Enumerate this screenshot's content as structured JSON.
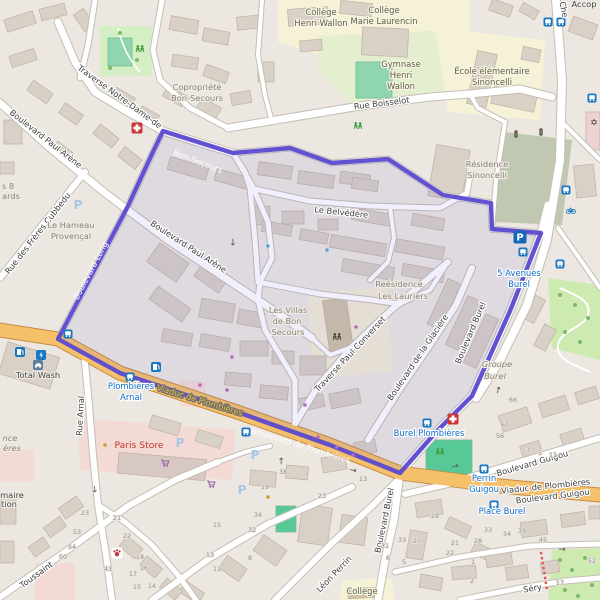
{
  "map": {
    "route_color": "#5a49cf",
    "selection_fill": "rgba(110,100,215,0.10)",
    "road_fill": "#ffffff",
    "primary_road_fill": "#f4c069",
    "background": "#ece7e1",
    "labels": [
      {
        "style": "road",
        "text": "Traverse Notre-Dame-de",
        "x": 118,
        "y": 99,
        "rot": 36
      },
      {
        "style": "road",
        "text": "Boulevard Paul Arène",
        "x": 44,
        "y": 141,
        "rot": 38
      },
      {
        "style": "road",
        "text": "Boulevard Paul Arène",
        "x": 187,
        "y": 249,
        "rot": 33
      },
      {
        "style": "road",
        "text": "Rue des Frères Cubbedu",
        "x": 40,
        "y": 235,
        "rot": -52
      },
      {
        "style": "road",
        "text": "Rue Boisselot",
        "x": 382,
        "y": 106,
        "rot": -7
      },
      {
        "style": "road",
        "text": "Le Belvédère",
        "x": 341,
        "y": 215,
        "rot": 6
      },
      {
        "style": "road",
        "text": "Traverse Paul Converset",
        "x": 352,
        "y": 356,
        "rot": -47
      },
      {
        "style": "road",
        "text": "Boulevard de la Glacière",
        "x": 420,
        "y": 359,
        "rot": -56
      },
      {
        "style": "road",
        "text": "Boulevard Burel",
        "x": 473,
        "y": 334,
        "rot": -67
      },
      {
        "style": "road",
        "text": "Boulevard Burel",
        "x": 387,
        "y": 521,
        "rot": -78
      },
      {
        "style": "road",
        "text": "Léon Perrin",
        "x": 336,
        "y": 576,
        "rot": -46
      },
      {
        "style": "road",
        "text": "Rue Arnal",
        "x": 83,
        "y": 416,
        "rot": -87
      },
      {
        "style": "road",
        "text": "Boulevard Guigou",
        "x": 533,
        "y": 466,
        "rot": -16
      },
      {
        "style": "road",
        "text": "Boulevard Guigou",
        "x": 553,
        "y": 499,
        "rot": -7
      },
      {
        "style": "road",
        "text": "Viaduc de Plombières",
        "x": 546,
        "y": 489,
        "rot": -6
      },
      {
        "style": "road",
        "text": "Séry",
        "x": 533,
        "y": 591,
        "rot": -10
      },
      {
        "style": "road",
        "text": "Che",
        "x": 561,
        "y": 10,
        "rot": 78
      },
      {
        "style": "road",
        "text": "Toussaint",
        "x": 38,
        "y": 577,
        "rot": -36
      },
      {
        "style": "route",
        "text": "Bon-Secours",
        "x": 197,
        "y": 164,
        "rot": 21
      },
      {
        "style": "route",
        "text": "Boulevard Long",
        "x": 93,
        "y": 272,
        "rot": -62
      },
      {
        "style": "route",
        "text": "Boulevard de Plombières",
        "x": 300,
        "y": 448,
        "rot": 17
      },
      {
        "style": "yellow",
        "text": "Viaduc de Plombières",
        "x": 199,
        "y": 403,
        "rot": 17
      },
      {
        "style": "transit",
        "text": "5 Avenues",
        "x": 519,
        "y": 276,
        "rot": 0
      },
      {
        "style": "transit",
        "text": "Burel",
        "x": 519,
        "y": 287,
        "rot": 0
      },
      {
        "style": "transit",
        "text": "Plombières",
        "x": 131,
        "y": 389,
        "rot": 0
      },
      {
        "style": "transit",
        "text": "Arnal",
        "x": 131,
        "y": 400,
        "rot": 0
      },
      {
        "style": "transit",
        "text": "Burel Plombières",
        "x": 429,
        "y": 436,
        "rot": 0
      },
      {
        "style": "transit",
        "text": "Perrin",
        "x": 484,
        "y": 481,
        "rot": 0
      },
      {
        "style": "transit",
        "text": "Guigou",
        "x": 484,
        "y": 492,
        "rot": 0
      },
      {
        "style": "transit",
        "text": "Place Burel",
        "x": 502,
        "y": 514,
        "rot": 0
      },
      {
        "style": "edu",
        "text": "Collège",
        "x": 321,
        "y": 15,
        "rot": 0
      },
      {
        "style": "edu",
        "text": "Henri Wallon",
        "x": 321,
        "y": 26,
        "rot": 0
      },
      {
        "style": "edu",
        "text": "Collège",
        "x": 384,
        "y": 13,
        "rot": 0
      },
      {
        "style": "edu",
        "text": "Marie Laurencin",
        "x": 384,
        "y": 24,
        "rot": 0
      },
      {
        "style": "edu",
        "text": "Gymnase",
        "x": 401,
        "y": 67,
        "rot": 0
      },
      {
        "style": "edu",
        "text": "Henri",
        "x": 401,
        "y": 78,
        "rot": 0
      },
      {
        "style": "edu",
        "text": "Wallon",
        "x": 401,
        "y": 89,
        "rot": 0
      },
      {
        "style": "edu",
        "text": "École élémentaire",
        "x": 492,
        "y": 74,
        "rot": 0
      },
      {
        "style": "edu",
        "text": "Sinoncelli",
        "x": 492,
        "y": 85,
        "rot": 0
      },
      {
        "style": "edu",
        "text": "Collège",
        "x": 362,
        "y": 594,
        "rot": 0
      },
      {
        "style": "place",
        "text": "Copropriété",
        "x": 197,
        "y": 90,
        "rot": 0
      },
      {
        "style": "place",
        "text": "Bon-Secours",
        "x": 197,
        "y": 101,
        "rot": 0
      },
      {
        "style": "place",
        "text": "Résidence",
        "x": 487,
        "y": 167,
        "rot": 0
      },
      {
        "style": "place",
        "text": "Sinoncelli",
        "x": 487,
        "y": 178,
        "rot": 0
      },
      {
        "style": "place",
        "text": "Reésidence",
        "x": 399,
        "y": 287,
        "rot": 0
      },
      {
        "style": "place",
        "text": "Les Lauriers",
        "x": 403,
        "y": 299,
        "rot": 0
      },
      {
        "style": "place",
        "text": "Les Villas",
        "x": 288,
        "y": 313,
        "rot": 0
      },
      {
        "style": "place",
        "text": "de Bon",
        "x": 287,
        "y": 324,
        "rot": 0
      },
      {
        "style": "place",
        "text": "Secours",
        "x": 288,
        "y": 335,
        "rot": 0
      },
      {
        "style": "place",
        "text": "Le Hameau",
        "x": 71,
        "y": 228,
        "rot": 0
      },
      {
        "style": "place",
        "text": "Provençal",
        "x": 71,
        "y": 239,
        "rot": 0
      },
      {
        "style": "placeit",
        "text": "Groupe",
        "x": 497,
        "y": 367,
        "rot": 0
      },
      {
        "style": "placeit",
        "text": "Burel",
        "x": 495,
        "y": 379,
        "rot": 0
      },
      {
        "style": "place",
        "text": "s 8",
        "x": 8,
        "y": 189,
        "rot": 0
      },
      {
        "style": "place",
        "text": "ards",
        "x": 11,
        "y": 199,
        "rot": 0
      },
      {
        "style": "placeit",
        "text": "nce",
        "x": 10,
        "y": 441,
        "rot": 0
      },
      {
        "style": "placeit",
        "text": "ères",
        "x": 12,
        "y": 451,
        "rot": 0
      },
      {
        "style": "dark",
        "text": "Total Wash",
        "x": 38,
        "y": 378,
        "rot": 0
      },
      {
        "style": "dark",
        "text": "Accop",
        "x": 584,
        "y": 7,
        "rot": 0
      },
      {
        "style": "dark",
        "text": "maire",
        "x": 12,
        "y": 498,
        "rot": 0
      },
      {
        "style": "dark",
        "text": "tion",
        "x": 9,
        "y": 507,
        "rot": 0
      },
      {
        "style": "shop",
        "text": "Paris Store",
        "x": 139,
        "y": 448,
        "rot": 0
      }
    ],
    "house_numbers": [
      [
        513,
        402,
        "66"
      ],
      [
        505,
        427,
        "60"
      ],
      [
        500,
        438,
        "56"
      ],
      [
        528,
        452,
        "3"
      ],
      [
        540,
        455,
        "5"
      ],
      [
        553,
        457,
        "11"
      ],
      [
        283,
        474,
        "38"
      ],
      [
        265,
        489,
        "19"
      ],
      [
        322,
        498,
        "23"
      ],
      [
        363,
        481,
        "13"
      ],
      [
        435,
        518,
        "28"
      ],
      [
        258,
        517,
        "34"
      ],
      [
        252,
        532,
        "32"
      ],
      [
        217,
        527,
        "15"
      ],
      [
        210,
        557,
        "13"
      ],
      [
        217,
        571,
        "11"
      ],
      [
        250,
        560,
        "8"
      ],
      [
        385,
        548,
        "31"
      ],
      [
        388,
        560,
        "6"
      ],
      [
        85,
        515,
        "23"
      ],
      [
        117,
        520,
        "21"
      ],
      [
        77,
        534,
        "53"
      ],
      [
        127,
        538,
        "22"
      ],
      [
        72,
        549,
        "54"
      ],
      [
        63,
        559,
        "50"
      ],
      [
        108,
        571,
        "43"
      ],
      [
        140,
        559,
        "18"
      ],
      [
        133,
        576,
        "17"
      ],
      [
        144,
        570,
        "16"
      ],
      [
        137,
        589,
        "15"
      ],
      [
        152,
        588,
        "14"
      ],
      [
        402,
        542,
        "33"
      ],
      [
        417,
        543,
        "20"
      ],
      [
        404,
        564,
        "5"
      ],
      [
        455,
        545,
        "21"
      ],
      [
        450,
        555,
        "22"
      ],
      [
        478,
        543,
        "28"
      ],
      [
        488,
        532,
        "33"
      ],
      [
        507,
        536,
        "34"
      ],
      [
        522,
        533,
        "39"
      ],
      [
        543,
        542,
        "45"
      ],
      [
        592,
        563,
        "52"
      ],
      [
        560,
        585,
        "17"
      ],
      [
        472,
        583,
        "2"
      ],
      [
        473,
        564,
        "1"
      ]
    ],
    "icons": [
      [
        "pharmacy",
        137,
        128
      ],
      [
        "pharmacy",
        453,
        419
      ],
      [
        "vet",
        117,
        553
      ],
      [
        "fuel",
        20,
        352
      ],
      [
        "ev",
        41,
        355
      ],
      [
        "fuel",
        156,
        367
      ],
      [
        "carwash",
        38,
        365
      ],
      [
        "bus",
        68,
        334
      ],
      [
        "bus",
        130,
        377
      ],
      [
        "bus",
        246,
        432
      ],
      [
        "bus",
        427,
        423
      ],
      [
        "bus",
        484,
        469
      ],
      [
        "bus",
        494,
        505
      ],
      [
        "bus",
        566,
        190
      ],
      [
        "bus",
        560,
        264
      ],
      [
        "bus",
        548,
        22
      ],
      [
        "bus",
        561,
        22
      ],
      [
        "bus",
        592,
        98
      ],
      [
        "bus",
        523,
        252
      ],
      [
        "pbig",
        520,
        237
      ],
      [
        "psmall",
        180,
        443
      ],
      [
        "psmall",
        255,
        455
      ],
      [
        "psmall",
        78,
        205
      ],
      [
        "psmall",
        242,
        490
      ],
      [
        "play",
        140,
        49
      ],
      [
        "play",
        358,
        126
      ],
      [
        "play",
        440,
        452
      ],
      [
        "kind",
        337,
        337
      ],
      [
        "bike",
        571,
        210
      ],
      [
        "cart",
        165,
        463
      ],
      [
        "cart",
        211,
        484
      ],
      [
        "worship",
        594,
        122
      ],
      [
        "signal",
        516,
        134
      ],
      [
        "signal",
        541,
        132
      ],
      [
        "drop",
        268,
        246
      ],
      [
        "drop",
        327,
        250
      ],
      [
        "sdot",
        200,
        385
      ],
      [
        "sdot",
        227,
        390
      ],
      [
        "sdot",
        305,
        405
      ],
      [
        "sdot",
        318,
        437
      ],
      [
        "sdot",
        337,
        447
      ],
      [
        "sdot",
        353,
        455
      ],
      [
        "sdot",
        232,
        357
      ],
      [
        "sdot",
        356,
        327
      ],
      [
        "odot",
        105,
        445
      ],
      [
        "odot",
        268,
        497
      ],
      [
        "arrow",
        233,
        242,
        90
      ],
      [
        "arrow",
        281,
        461,
        -90
      ],
      [
        "arrow",
        353,
        470,
        12
      ],
      [
        "arrow",
        455,
        466,
        -15
      ],
      [
        "arrow",
        498,
        390,
        -75
      ],
      [
        "arrow",
        562,
        549,
        0
      ],
      [
        "arrow",
        95,
        489,
        85
      ]
    ]
  }
}
